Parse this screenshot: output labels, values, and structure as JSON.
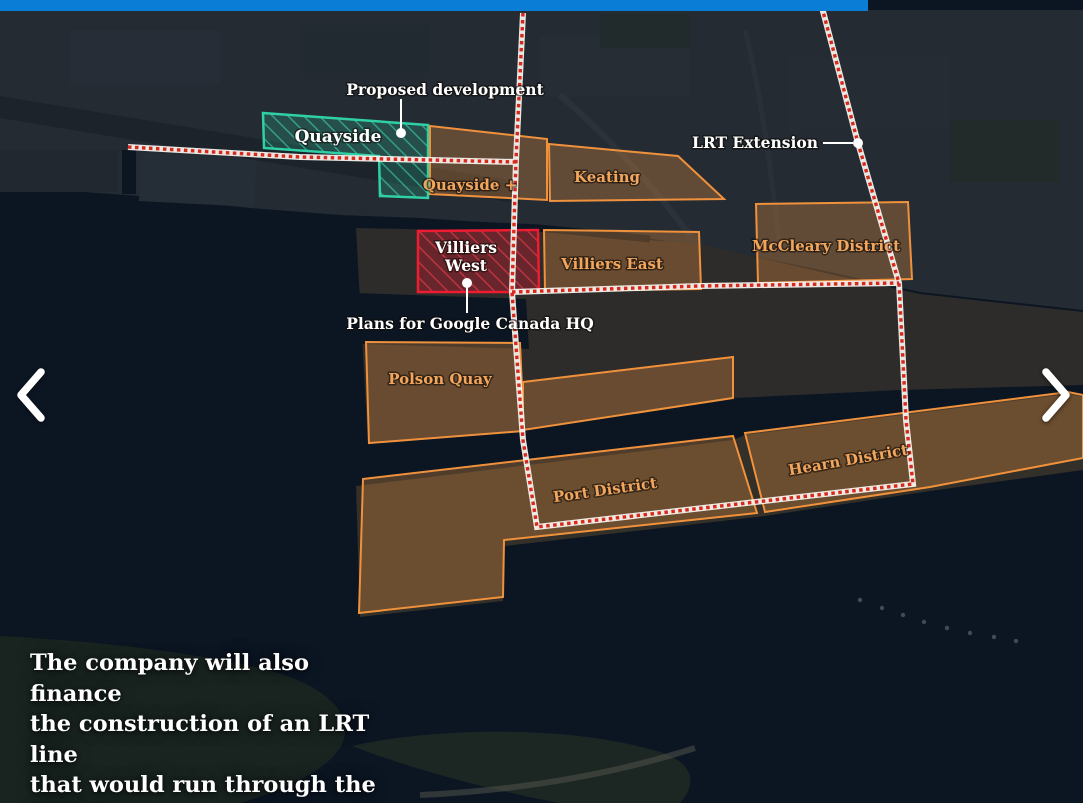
{
  "map": {
    "district_labels": {
      "quayside": "Quayside",
      "quayside_plus": "Quayside +",
      "keating": "Keating",
      "villiers_west_line1": "Villiers",
      "villiers_west_line2": "West",
      "villiers_east": "Villiers East",
      "mccleary": "McCleary District",
      "polson_quay": "Polson Quay",
      "port_district": "Port District",
      "hearn_district": "Hearn District"
    },
    "annotations": {
      "proposed_development": "Proposed development",
      "lrt_extension": "LRT Extension",
      "google_hq": "Plans for Google Canada HQ"
    },
    "colors": {
      "progress_bar_blue": "#0a7ed6",
      "district_outline_orange": "#f0913c",
      "district_label_orange": "#f2a55c",
      "quayside_teal": "#2fd0a6",
      "villiers_west_red": "#ee1b31",
      "lrt_line_red": "#d6281c",
      "water_dark": "#0d1824"
    }
  },
  "caption": {
    "text": "The company will also finance the construction of an LRT line that would run through the district.",
    "lines": [
      "The company will also finance",
      "the construction of an LRT line",
      "that would run through the",
      "district."
    ]
  }
}
